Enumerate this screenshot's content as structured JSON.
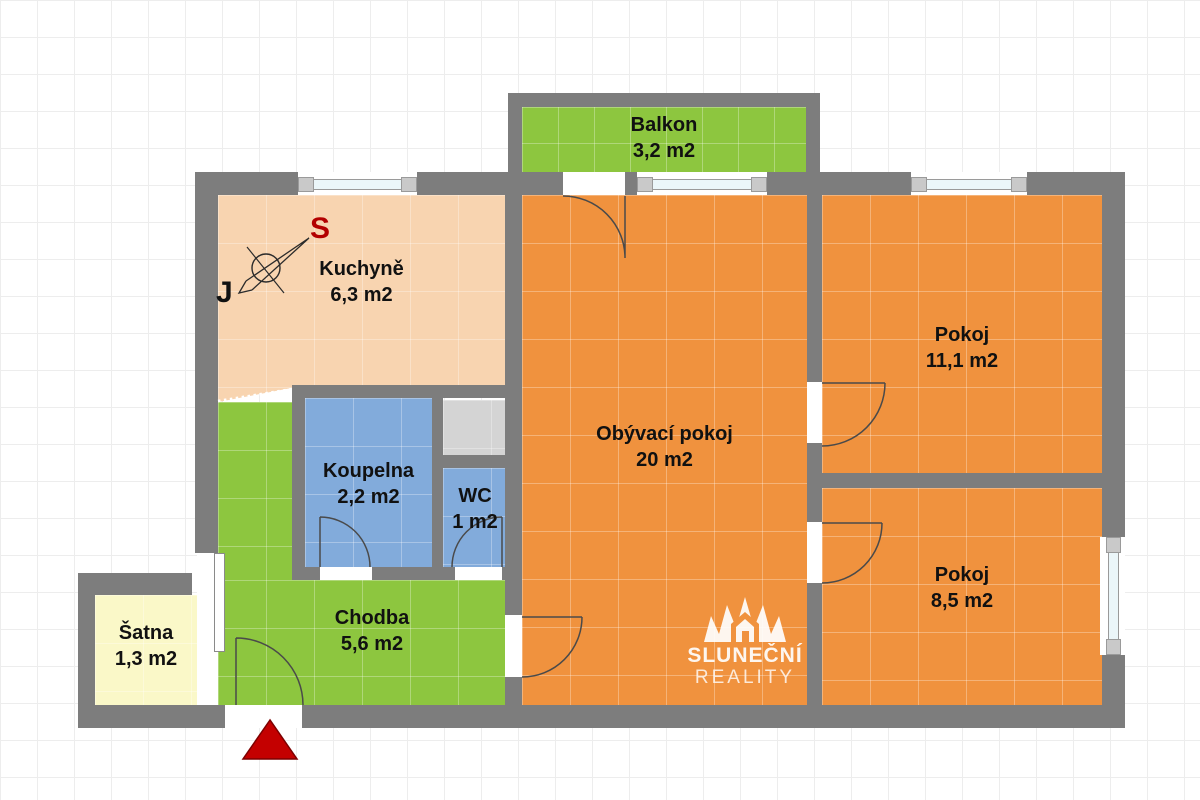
{
  "plan": {
    "title": "Apartment floor plan",
    "rooms": [
      {
        "id": "balkon",
        "name": "Balkon",
        "area": "3,2 m2"
      },
      {
        "id": "kuchyne",
        "name": "Kuchyně",
        "area": "6,3 m2"
      },
      {
        "id": "obyvaci-pokoj",
        "name": "Obývací pokoj",
        "area": "20 m2"
      },
      {
        "id": "pokoj-1",
        "name": "Pokoj",
        "area": "11,1 m2"
      },
      {
        "id": "pokoj-2",
        "name": "Pokoj",
        "area": "8,5 m2"
      },
      {
        "id": "koupelna",
        "name": "Koupelna",
        "area": "2,2 m2"
      },
      {
        "id": "wc",
        "name": "WC",
        "area": "1 m2"
      },
      {
        "id": "chodba",
        "name": "Chodba",
        "area": "5,6 m2"
      },
      {
        "id": "satna",
        "name": "Šatna",
        "area": "1,3 m2"
      }
    ],
    "compass": {
      "north_label": "S",
      "south_label": "J"
    },
    "watermark": {
      "line1": "SLUNEČNÍ",
      "line2": "REALITY"
    },
    "colors": {
      "wall": "#7d7d7d",
      "room_orange": "#F0923E",
      "kitchen_salmon": "#F8D4B0",
      "green": "#8DC63F",
      "blue": "#82ABDB",
      "yellow": "#FAF8C8",
      "shaft_gray": "#D4D4D4",
      "entrance_red": "#C40000",
      "compass_north": "#B30000",
      "watermark": "#FFFFFF"
    }
  }
}
